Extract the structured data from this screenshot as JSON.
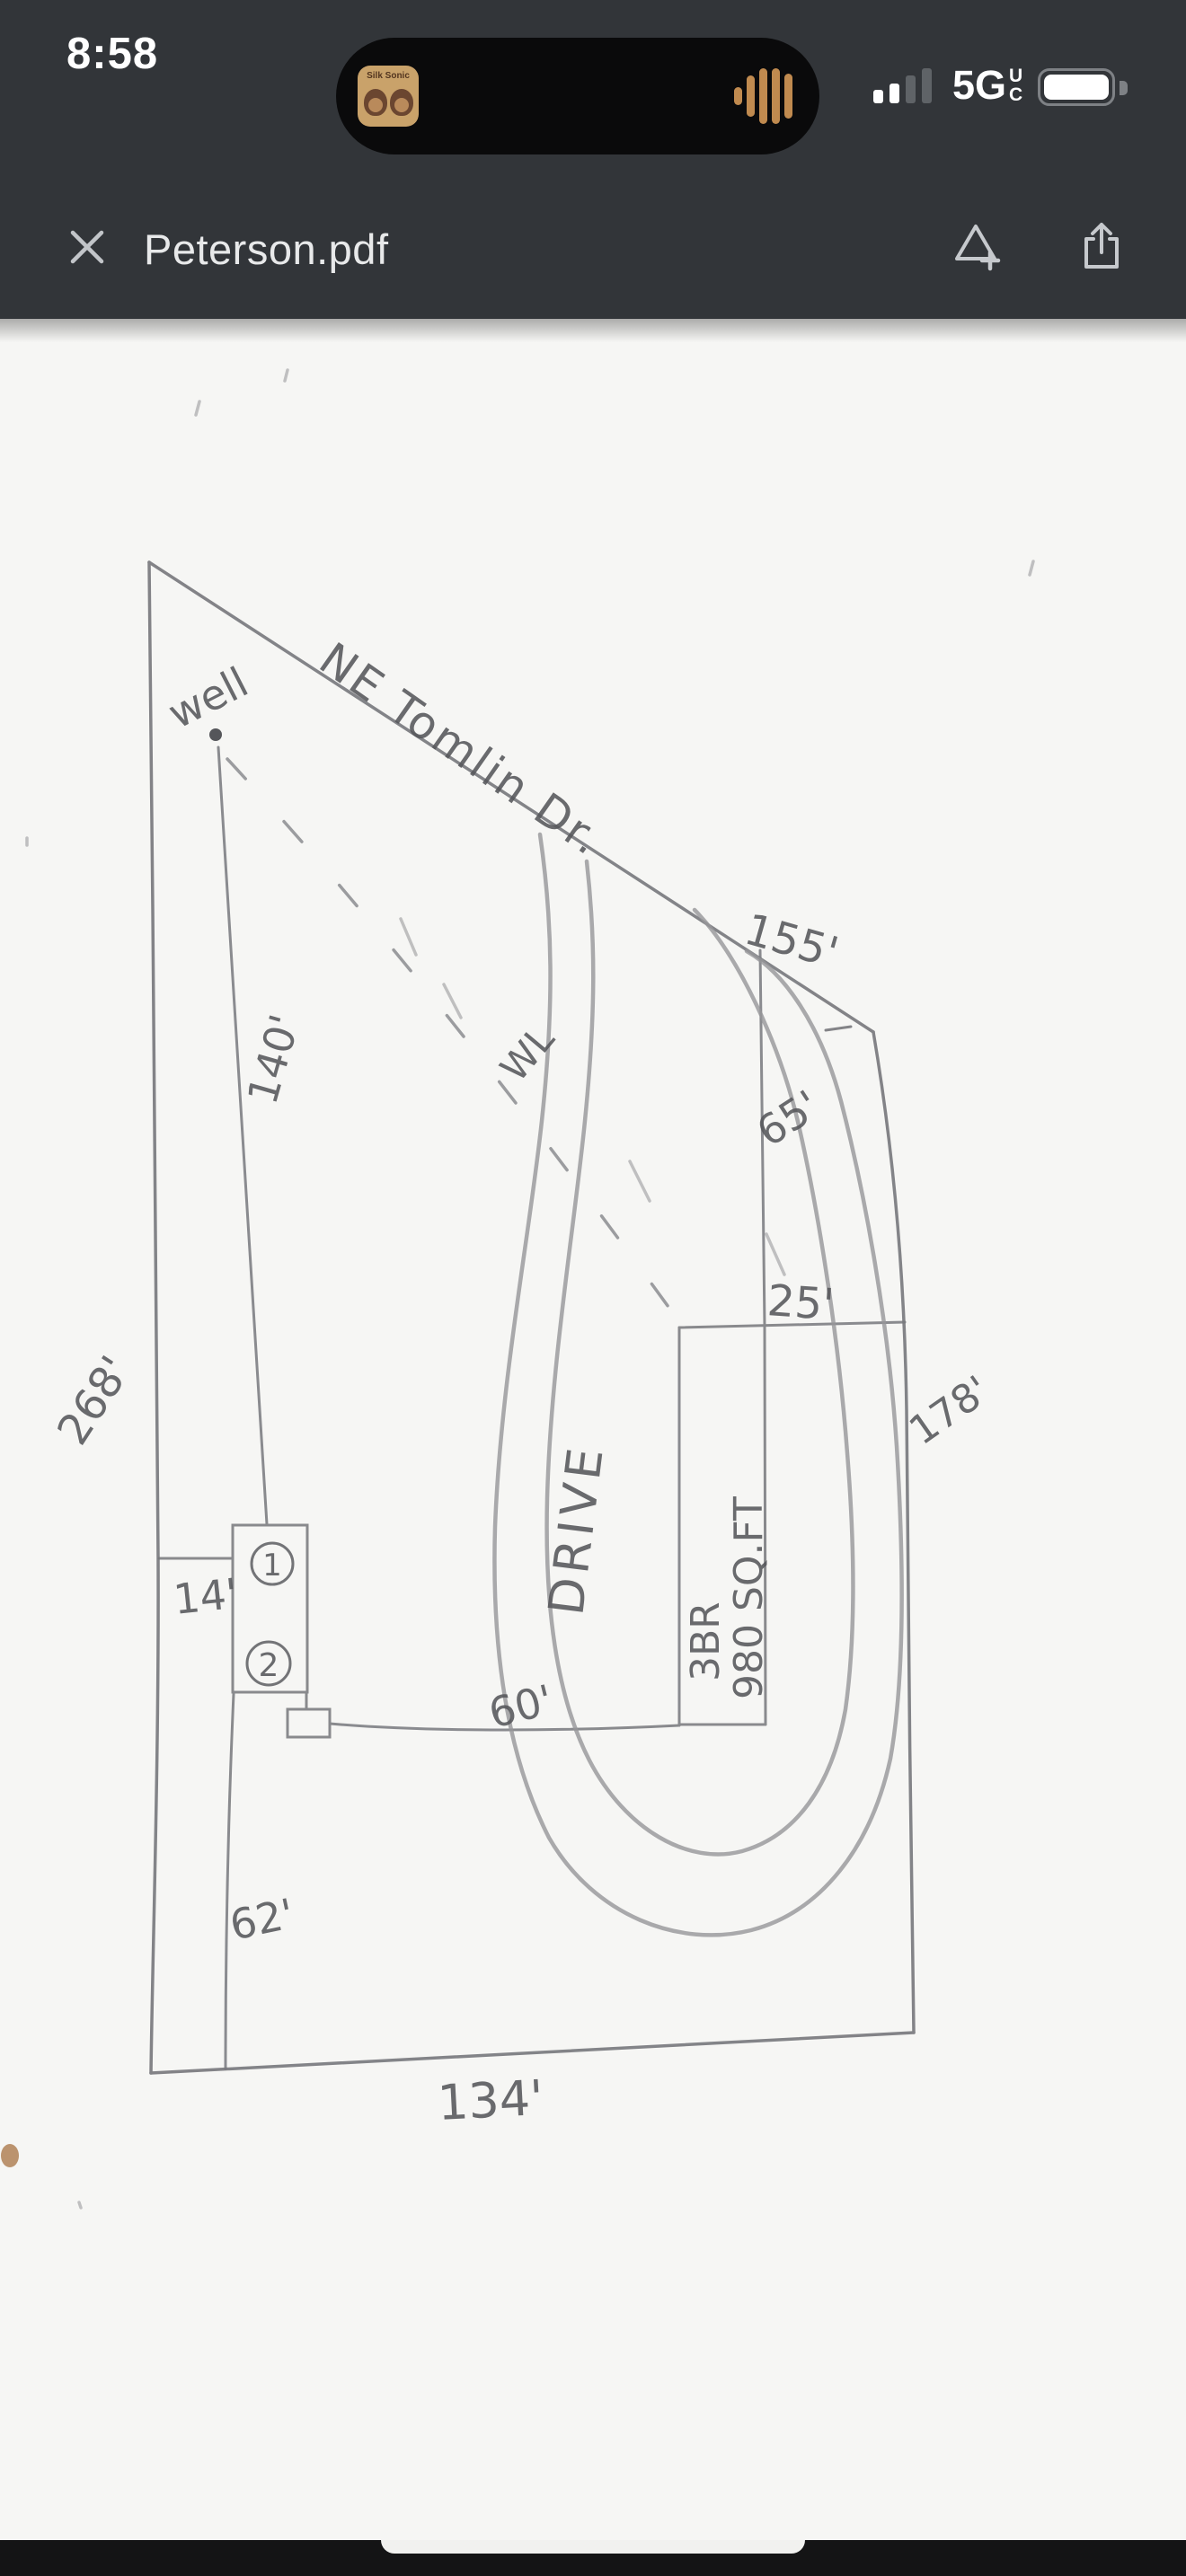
{
  "status_bar": {
    "time": "8:58",
    "network": "5G",
    "network_badge_top": "U",
    "network_badge_bottom": "C",
    "signal_bars_total": 4,
    "signal_bars_active": 2,
    "battery_fill_percent": 93,
    "now_playing_album": "Silk Sonic"
  },
  "toolbar": {
    "title": "Peterson.pdf"
  },
  "sketch": {
    "road_label": "NE Tomlin Dr.",
    "well_label": "well",
    "drive_label": "DRIVE",
    "water_line_label": "WL",
    "house_line1": "3BR",
    "house_line2": "980 SQ.FT",
    "unit_1": "1",
    "unit_2": "2",
    "dim_road_frontage": "155'",
    "dim_east_upper": "65'",
    "dim_east_setback": "25'",
    "dim_east_side": "178'",
    "dim_west_side": "268'",
    "dim_well_to_house": "140'",
    "dim_house_offset": "14'",
    "dim_drive_to_house": "60'",
    "dim_southwest": "62'",
    "dim_south": "134'"
  },
  "colors": {
    "header_bg": "#323539",
    "page_bg": "#f6f6f4",
    "pencil_line": "#6f7074",
    "handwriting": "#56575b",
    "waveform": "#c08a4f",
    "album_tan": "#c9a26a"
  }
}
